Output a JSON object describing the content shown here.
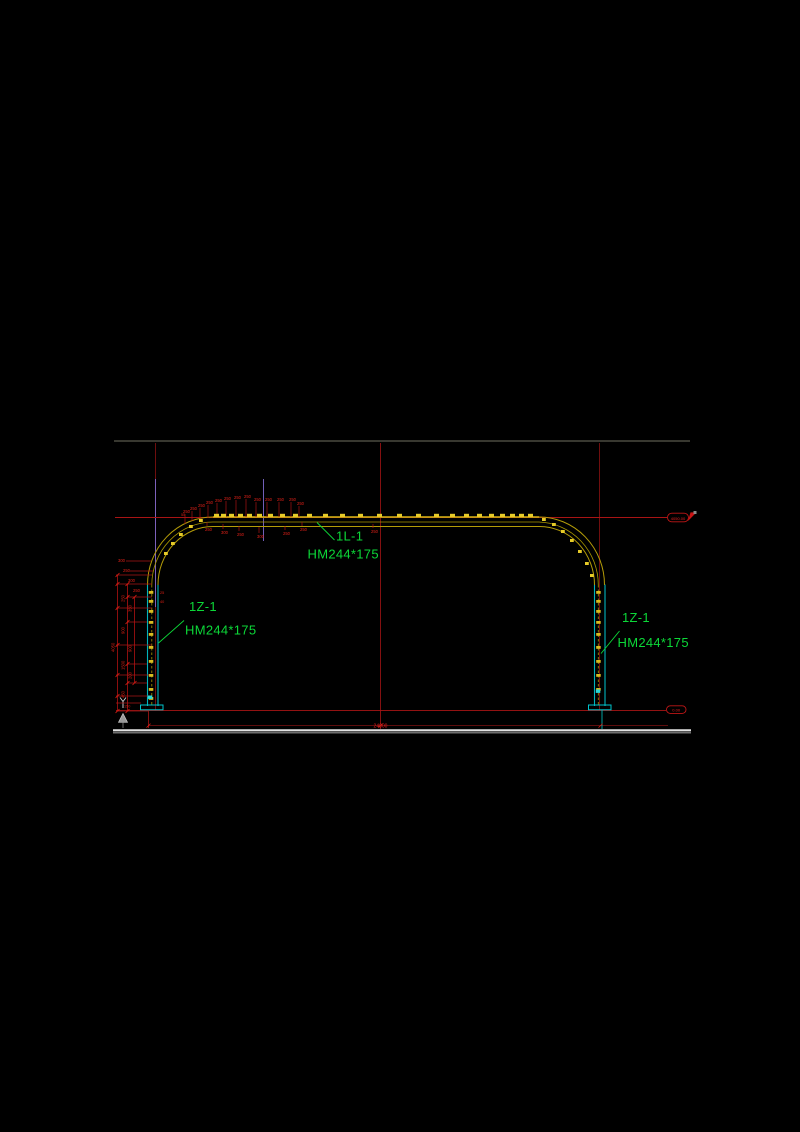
{
  "canvas": {
    "width": 800,
    "height": 1132,
    "background": "#000000"
  },
  "colors": {
    "frame_yellow": "#b49c08",
    "frame_yellow_bright": "#d6ba16",
    "cleat_yellow": "#e6cb28",
    "column_cyan": "#00b4bc",
    "cyan_bright": "#2ad8d8",
    "dim_red": "#dd1f14",
    "line_red": "#a81414",
    "grid_dark_red": "#7c1010",
    "violet": "#7e6ace",
    "label_green": "#0cd838",
    "ground_white": "#e2e2e2",
    "ground_gray": "#6f6f6f",
    "border_gray": "#4b4b41",
    "datum_gray": "#9a9a9a"
  },
  "frame_labels": {
    "beam": {
      "tag": "1L-1",
      "size": "HM244*175"
    },
    "left_column": {
      "tag": "1Z-1",
      "size": "HM244*175"
    },
    "right_column": {
      "tag": "1Z-1",
      "size": "HM244*175"
    }
  },
  "elevation_markers": {
    "roof": "4050.00",
    "base": "0.00"
  },
  "dimensions": {
    "span_total": "24000",
    "height_total": "4050"
  },
  "annotations": [
    {
      "name": "dim-ext-line",
      "kind": "line",
      "color": "#a81414",
      "sw": 0.8,
      "items": [
        [
          126,
          561,
          151,
          561
        ],
        [
          130,
          571,
          153,
          571
        ],
        [
          116,
          575,
          152,
          575
        ],
        [
          116,
          584,
          152,
          584
        ],
        [
          127,
          597,
          152,
          597
        ],
        [
          116,
          608,
          152,
          608
        ],
        [
          127,
          622,
          147,
          622
        ],
        [
          116,
          645,
          152,
          645
        ],
        [
          127,
          664,
          147,
          664
        ],
        [
          116,
          675,
          152,
          675
        ],
        [
          127,
          683,
          147,
          683
        ],
        [
          116,
          696,
          152,
          696
        ],
        [
          116,
          703,
          141,
          703
        ],
        [
          116,
          711,
          148,
          711
        ]
      ]
    },
    {
      "name": "dim-chain-line",
      "kind": "line",
      "color": "#b01212",
      "sw": 0.8,
      "items": [
        [
          117.5,
          575,
          117.5,
          711
        ],
        [
          127.5,
          584,
          127.5,
          711
        ],
        [
          134.5,
          597,
          134.5,
          683
        ]
      ]
    },
    {
      "name": "dim-tick",
      "kind": "tick",
      "color": "#dd1f14",
      "items": [
        [
          117.5,
          575
        ],
        [
          117.5,
          584
        ],
        [
          117.5,
          608
        ],
        [
          117.5,
          645
        ],
        [
          117.5,
          675
        ],
        [
          117.5,
          696
        ],
        [
          117.5,
          711
        ],
        [
          127.5,
          584
        ],
        [
          127.5,
          597
        ],
        [
          127.5,
          622
        ],
        [
          127.5,
          664
        ],
        [
          127.5,
          683
        ],
        [
          127.5,
          711
        ],
        [
          134.5,
          597
        ],
        [
          134.5,
          683
        ],
        [
          148.5,
          725.6
        ],
        [
          380.5,
          725.6
        ],
        [
          600.5,
          725.6
        ]
      ]
    },
    {
      "name": "dim-chain-value",
      "kind": "vtext",
      "color": "#dd1f14",
      "size": 4.2,
      "items": [
        [
          114.5,
          652,
          "4050"
        ],
        [
          124.5,
          602,
          "250"
        ],
        [
          124.5,
          634,
          "900"
        ],
        [
          124.5,
          670,
          "1500"
        ],
        [
          124.5,
          698,
          "450"
        ],
        [
          131.5,
          612,
          "350"
        ],
        [
          131.5,
          652,
          "900"
        ],
        [
          131.5,
          679,
          "200"
        ]
      ]
    },
    {
      "name": "dim-small-value",
      "kind": "text",
      "color": "#dd1f14",
      "size": 3.8,
      "items": [
        [
          124,
          707.5,
          "150"
        ],
        [
          160,
          594,
          "25"
        ],
        [
          160,
          603,
          "40"
        ],
        [
          181,
          516,
          "55"
        ]
      ]
    },
    {
      "name": "purlin-flag-value",
      "kind": "text",
      "color": "#e02018",
      "size": 4.2,
      "items": [
        [
          183,
          513,
          "250"
        ],
        [
          190,
          510,
          "250"
        ],
        [
          198,
          507,
          "250"
        ],
        [
          206,
          504,
          "250"
        ],
        [
          215,
          502,
          "250"
        ],
        [
          224,
          500,
          "250"
        ],
        [
          234,
          499,
          "250"
        ],
        [
          244,
          498,
          "250"
        ],
        [
          254,
          501,
          "250"
        ],
        [
          265,
          501,
          "250"
        ],
        [
          277,
          501,
          "250"
        ],
        [
          289,
          501,
          "250"
        ],
        [
          297,
          505,
          "250"
        ]
      ]
    },
    {
      "name": "purlin-flag-leader",
      "kind": "line",
      "color": "#a81414",
      "sw": 0.7,
      "items": [
        [
          185,
          514,
          185,
          524
        ],
        [
          192,
          511,
          192,
          521
        ],
        [
          200,
          508,
          200,
          519
        ],
        [
          208,
          505,
          208,
          518
        ],
        [
          217,
          503,
          217,
          517
        ],
        [
          226,
          501,
          226,
          517
        ],
        [
          236,
          500,
          236,
          517
        ],
        [
          246,
          499,
          246,
          517
        ],
        [
          256,
          502,
          256,
          517
        ],
        [
          267,
          502,
          267,
          517
        ],
        [
          279,
          502,
          279,
          517
        ],
        [
          291,
          502,
          291,
          517
        ],
        [
          299,
          506,
          299,
          517
        ]
      ]
    },
    {
      "name": "under-beam-flag-value",
      "kind": "text",
      "color": "#e02018",
      "size": 4.2,
      "items": [
        [
          205,
          531,
          "250"
        ],
        [
          221,
          534,
          "300"
        ],
        [
          237,
          536,
          "250"
        ],
        [
          257,
          538,
          "300"
        ],
        [
          283,
          535,
          "250"
        ],
        [
          300,
          531,
          "250"
        ],
        [
          371,
          533,
          "250"
        ]
      ]
    },
    {
      "name": "under-beam-flag-leader",
      "kind": "line",
      "color": "#a81414",
      "sw": 0.7,
      "items": [
        [
          207,
          526,
          207,
          522
        ],
        [
          223,
          529,
          223,
          524
        ],
        [
          239,
          531,
          239,
          526
        ],
        [
          259,
          533,
          259,
          527
        ],
        [
          285,
          530,
          285,
          526
        ],
        [
          302,
          526,
          302,
          522
        ],
        [
          373,
          528,
          373,
          524
        ]
      ]
    },
    {
      "name": "arc-side-flag-value",
      "kind": "text",
      "color": "#e02018",
      "size": 4.2,
      "items": [
        [
          118,
          562,
          "300"
        ],
        [
          123,
          572,
          "250"
        ],
        [
          128,
          582,
          "300"
        ],
        [
          133,
          592,
          "250"
        ]
      ]
    },
    {
      "name": "beam-cleat",
      "kind": "rect",
      "color": "#e6cb28",
      "w": 5,
      "h": 3.2,
      "items": [
        [
          214,
          513.8
        ],
        [
          221,
          513.8
        ],
        [
          229,
          513.8
        ],
        [
          238,
          513.8
        ],
        [
          247,
          513.8
        ],
        [
          257,
          513.8
        ],
        [
          268,
          513.8
        ],
        [
          280,
          513.8
        ],
        [
          293,
          513.8
        ],
        [
          307,
          513.8
        ],
        [
          323,
          513.8
        ],
        [
          340,
          513.8
        ],
        [
          358,
          513.8
        ],
        [
          377,
          513.8
        ],
        [
          397,
          513.8
        ],
        [
          416,
          513.8
        ],
        [
          434,
          513.8
        ],
        [
          450,
          513.8
        ],
        [
          464,
          513.8
        ],
        [
          477,
          513.8
        ],
        [
          489,
          513.8
        ],
        [
          500,
          513.8
        ],
        [
          510,
          513.8
        ],
        [
          519,
          513.8
        ],
        [
          528,
          513.8
        ]
      ]
    },
    {
      "name": "arc-cleat",
      "kind": "rect",
      "color": "#e6cb28",
      "w": 3.8,
      "h": 3,
      "items": [
        [
          164,
          552
        ],
        [
          171,
          542
        ],
        [
          179,
          533
        ],
        [
          189,
          525
        ],
        [
          199,
          519
        ],
        [
          542,
          518
        ],
        [
          552,
          523
        ],
        [
          561,
          530
        ],
        [
          570,
          539
        ],
        [
          578,
          550
        ],
        [
          585,
          562
        ],
        [
          590,
          574
        ]
      ]
    },
    {
      "name": "column-rung",
      "kind": "rect",
      "color": "#d8bc20",
      "w": 4.5,
      "h": 2.8,
      "items": [
        [
          148.8,
          591
        ],
        [
          148.8,
          600
        ],
        [
          148.8,
          610
        ],
        [
          148.8,
          621
        ],
        [
          148.8,
          633
        ],
        [
          148.8,
          646
        ],
        [
          148.8,
          660
        ],
        [
          148.8,
          674
        ],
        [
          148.8,
          688
        ],
        [
          148.8,
          697
        ],
        [
          596.2,
          591
        ],
        [
          596.2,
          600
        ],
        [
          596.2,
          610
        ],
        [
          596.2,
          621
        ],
        [
          596.2,
          633
        ],
        [
          596.2,
          646
        ],
        [
          596.2,
          660
        ],
        [
          596.2,
          674
        ],
        [
          596.2,
          688
        ]
      ]
    },
    {
      "name": "column-cyan-mark",
      "kind": "rect",
      "color": "#2ad8d8",
      "w": 4.5,
      "h": 3.4,
      "items": [
        [
          147.8,
          695.5
        ],
        [
          595.8,
          689.5
        ]
      ]
    }
  ]
}
